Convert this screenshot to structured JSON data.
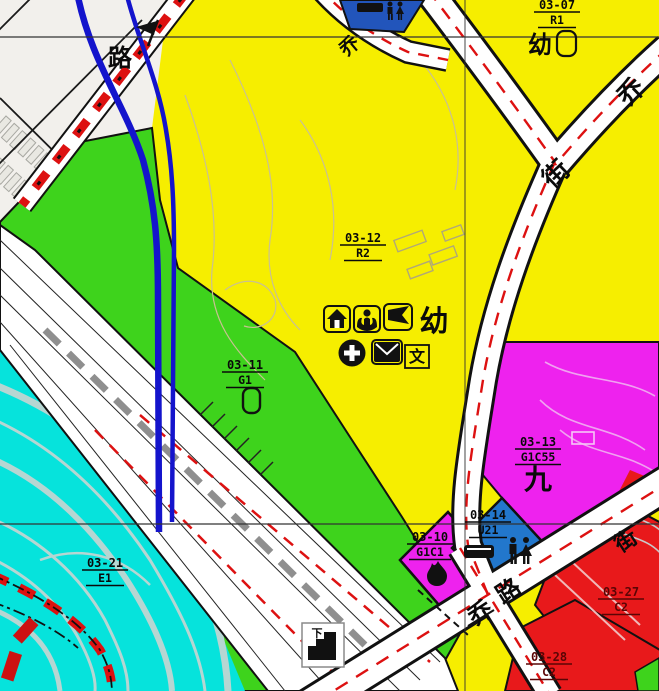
{
  "parcels": {
    "p03_07": {
      "id": "03-07",
      "code": "R1"
    },
    "p03_12": {
      "id": "03-12",
      "code": "R2"
    },
    "p03_11": {
      "id": "03-11",
      "code": "G1"
    },
    "p03_13": {
      "id": "03-13",
      "code": "G1C55"
    },
    "p03_10": {
      "id": "03-10",
      "code": "G1C1"
    },
    "p03_14": {
      "id": "03-14",
      "code": "U21"
    },
    "p03_21": {
      "id": "03-21",
      "code": "E1"
    },
    "p03_27": {
      "id": "03-27",
      "code": "C2"
    },
    "p03_28": {
      "id": "03-28",
      "code": "C2"
    }
  },
  "annotations": {
    "kindergarten_main": "幼",
    "kindergarten_north": "幼",
    "culture": "文",
    "nine": "九",
    "underpass": "下"
  },
  "road_names": {
    "lu_top_left": "路",
    "qiao_top_center": "乔",
    "qiao_top_right": "乔",
    "jie_top_right": "街",
    "qiao_bottom": "乔",
    "lu_bottom": "路",
    "jie_right": "街"
  },
  "legend_colors": {
    "residential": "#f6ee00",
    "green_space": "#3ed31c",
    "water": "#06e3dc",
    "mixed_use_magenta": "#ee22ee",
    "commercial": "#e8191b",
    "utility_blue": "#2277cc",
    "metro_line_blue": "#1414cc",
    "planning_red_line": "#dd1111",
    "survey_grid": "#333333"
  }
}
